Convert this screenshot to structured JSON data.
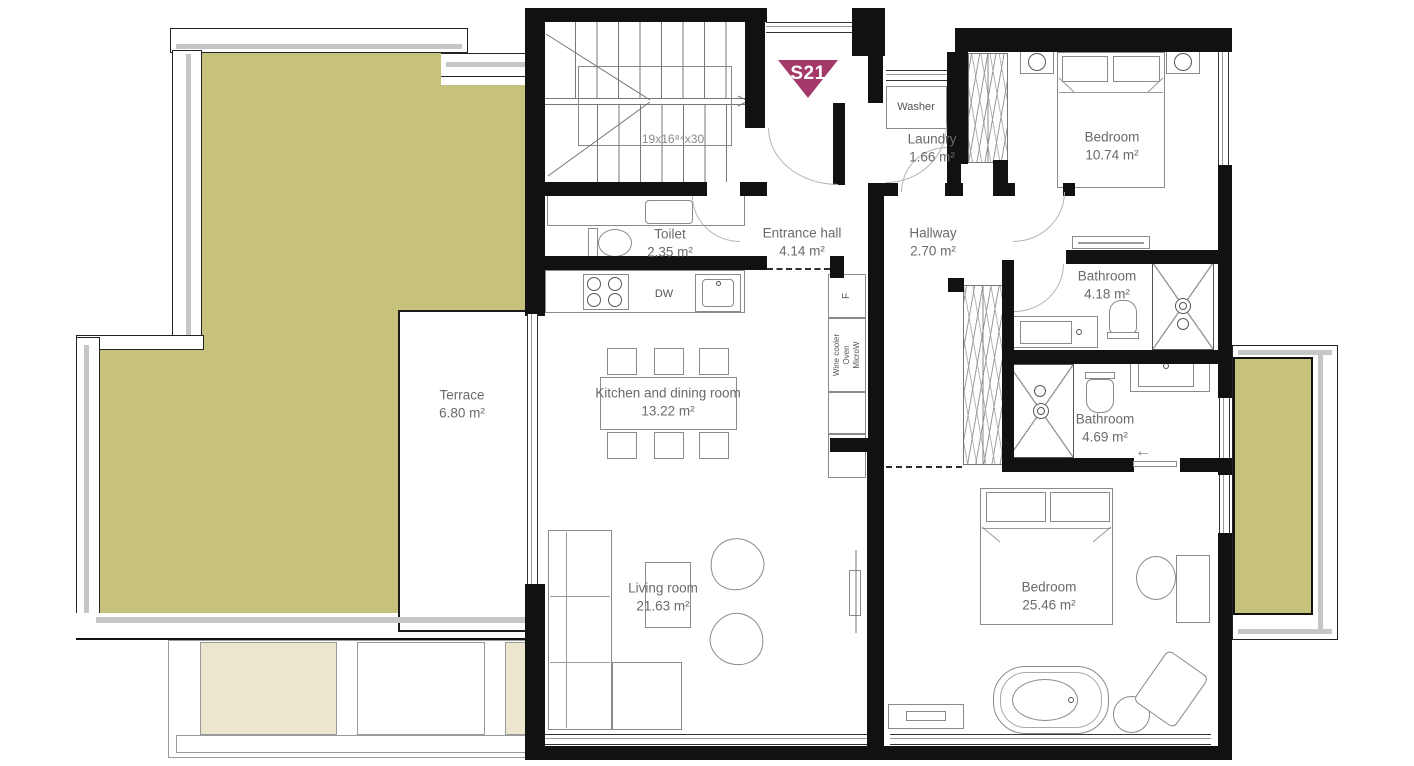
{
  "unit": {
    "badge": "S21"
  },
  "colors": {
    "terrace_fill": "#c6c17c",
    "panel_fill": "#ede6cf",
    "badge_fill": "#a33a6a",
    "wall": "#111111",
    "label_text": "#6a6a6a"
  },
  "rooms": {
    "terrace": {
      "name": "Terrace",
      "area": "6.80 m²"
    },
    "toilet": {
      "name": "Toilet",
      "area": "2.35 m²"
    },
    "entrance_hall": {
      "name": "Entrance hall",
      "area": "4.14 m²"
    },
    "hallway": {
      "name": "Hallway",
      "area": "2.70 m²"
    },
    "laundry": {
      "name": "Laundry",
      "area": "1.66 m²"
    },
    "bedroom1": {
      "name": "Bedroom",
      "area": "10.74 m²"
    },
    "bathroom1": {
      "name": "Bathroom",
      "area": "4.18 m²"
    },
    "bathroom2": {
      "name": "Bathroom",
      "area": "4.69 m²"
    },
    "kitchen": {
      "name": "Kitchen and dining room",
      "area": "13.22 m²"
    },
    "living_room": {
      "name": "Living room",
      "area": "21.63 m²"
    },
    "bedroom2": {
      "name": "Bedroom",
      "area": "25.46 m²"
    }
  },
  "stairs": {
    "dimensions": "19x16⁸⁴x30"
  },
  "appliances": {
    "washer": "Washer",
    "dishwasher": "DW",
    "fridge": "F",
    "tall_unit": [
      "Wine cooler",
      "Oven",
      "MicroW"
    ]
  },
  "icons": {
    "arrow_left": "←"
  }
}
